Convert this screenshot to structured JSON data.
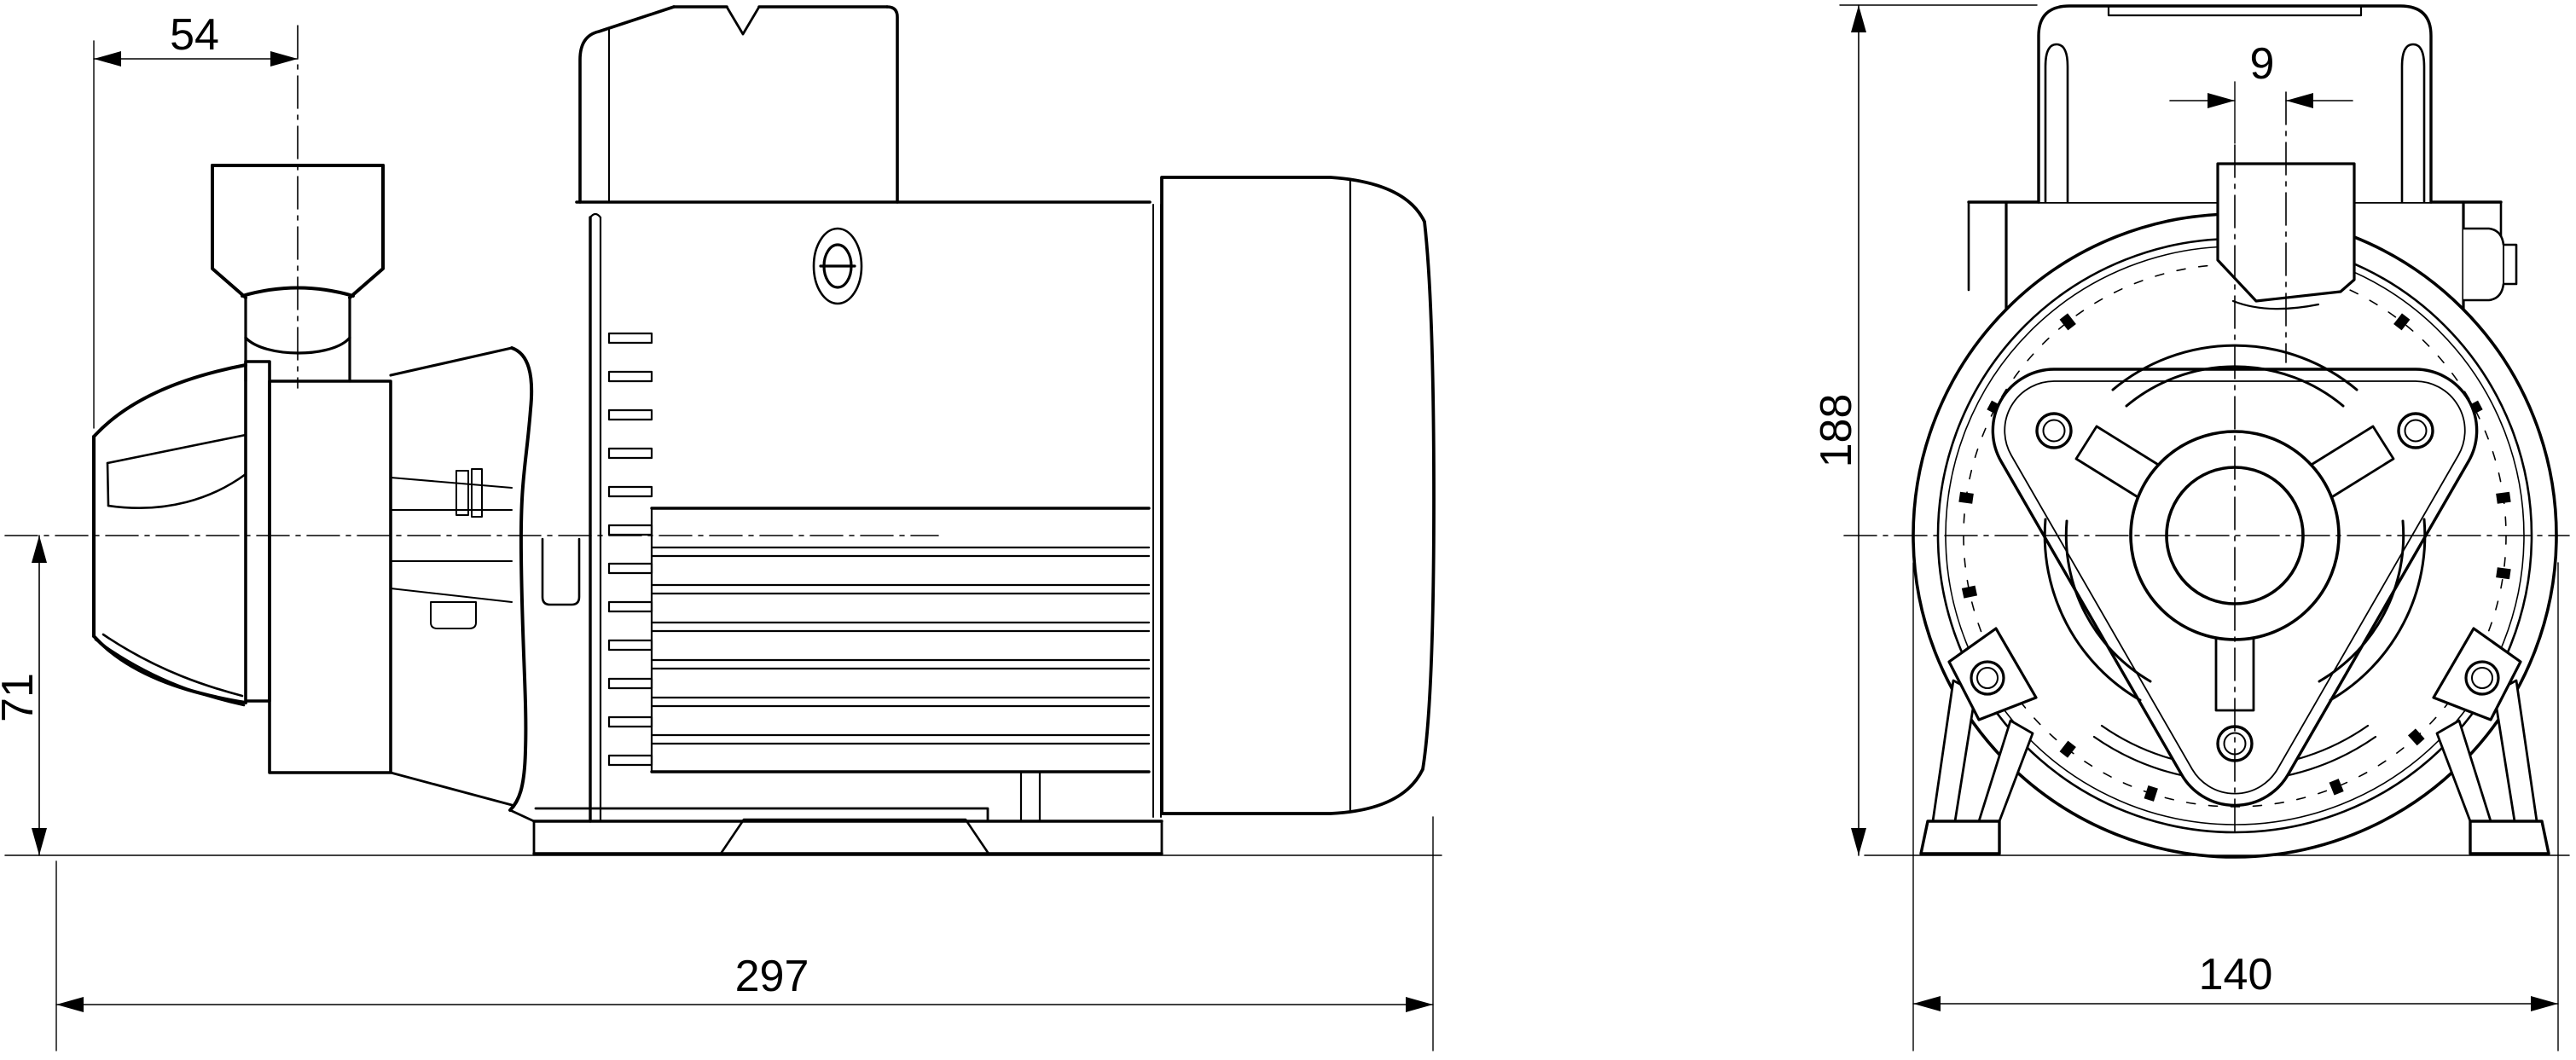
{
  "page": {
    "background": "#ffffff",
    "line_color": "#000000"
  },
  "dimensions": {
    "side_port_offset": "54",
    "side_axis_height": "71",
    "side_overall_length": "297",
    "front_port_offset": "9",
    "front_overall_height": "188",
    "front_overall_width": "140"
  }
}
